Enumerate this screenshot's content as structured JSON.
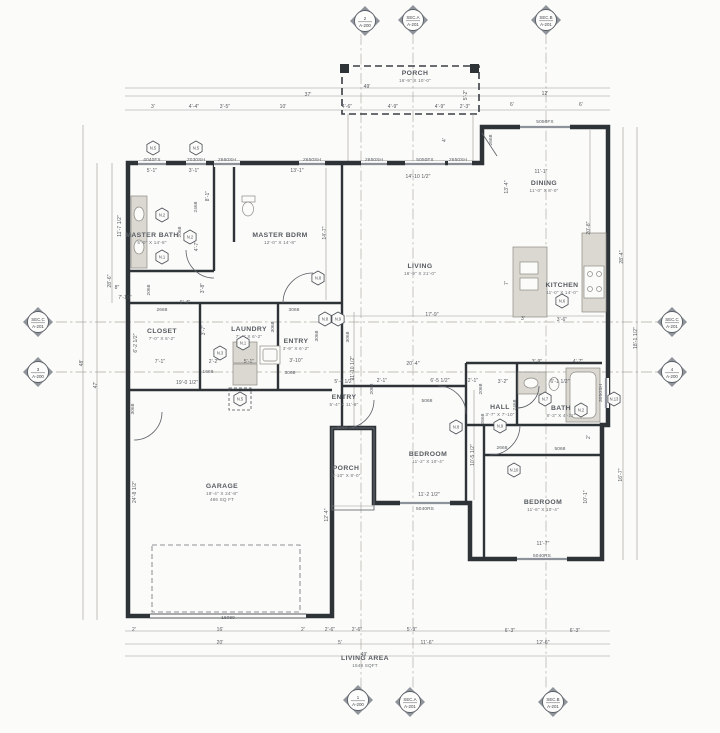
{
  "drawing": {
    "type": "architectural-floor-plan",
    "footer_label": "LIVING AREA",
    "footer_value": "1549 SQFT"
  },
  "rooms": [
    {
      "name": "PORCH",
      "size": "16'-9\" X 10'-0\"",
      "x": 415,
      "y": 75
    },
    {
      "name": "MASTER BATH",
      "size": "5'-0\" X 14'-8\"",
      "x": 152,
      "y": 237
    },
    {
      "name": "MASTER BDRM",
      "size": "12'-0\" X 14'-8\"",
      "x": 280,
      "y": 237
    },
    {
      "name": "LIVING",
      "size": "16'-9\" X 21'-0\"",
      "x": 420,
      "y": 268
    },
    {
      "name": "DINING",
      "size": "11'-0\" X 8'-0\"",
      "x": 544,
      "y": 185
    },
    {
      "name": "KITCHEN",
      "size": "11'-0\" X 14'-0\"",
      "x": 562,
      "y": 287
    },
    {
      "name": "CLOSET",
      "size": "7'-0\" X 6'-2\"",
      "x": 162,
      "y": 333
    },
    {
      "name": "LAUNDRY",
      "size": "7'-4\" X 6'-2\"",
      "x": 249,
      "y": 331
    },
    {
      "name": "ENTRY",
      "size": "3'-9\" X 6'-2\"",
      "x": 296,
      "y": 343
    },
    {
      "name": "ENTRY",
      "size": "5'-4\" X 11'-8\"",
      "x": 344,
      "y": 399
    },
    {
      "name": "PORCH",
      "size": "4'-10\" X 8'-0\"",
      "x": 346,
      "y": 470
    },
    {
      "name": "HALL",
      "size": "3'-7\" X 7'-10\"",
      "x": 500,
      "y": 409
    },
    {
      "name": "BATH",
      "size": "8'-3\" X 4'-11\"",
      "x": 561,
      "y": 410
    },
    {
      "name": "BEDROOM",
      "size": "11'-2\" X 10'-4\"",
      "x": 428,
      "y": 456
    },
    {
      "name": "BEDROOM",
      "size": "11'-6\" X 10'-4\"",
      "x": 543,
      "y": 504
    },
    {
      "name": "GARAGE",
      "size": "19'-4\" X 24'-8\"",
      "size2": "486 SQ FT",
      "x": 222,
      "y": 488
    },
    {
      "name": "LIVING AREA",
      "size": "1549 SQFT",
      "x": 365,
      "y": 660
    }
  ],
  "section_markers": [
    {
      "num": "2",
      "sheet": "A-200",
      "x": 365,
      "y": 21
    },
    {
      "num": "SEC.A",
      "sheet": "A-201",
      "x": 413,
      "y": 20
    },
    {
      "num": "SEC.B",
      "sheet": "A-201",
      "x": 546,
      "y": 20
    },
    {
      "num": "SEC.C",
      "sheet": "A-201",
      "x": 38,
      "y": 322
    },
    {
      "num": "3",
      "sheet": "A-200",
      "x": 38,
      "y": 372
    },
    {
      "num": "SEC.C",
      "sheet": "A-201",
      "x": 672,
      "y": 322
    },
    {
      "num": "4",
      "sheet": "A-200",
      "x": 672,
      "y": 372
    },
    {
      "num": "1",
      "sheet": "A-200",
      "x": 358,
      "y": 700
    },
    {
      "num": "SEC.A",
      "sheet": "A-201",
      "x": 410,
      "y": 702
    },
    {
      "num": "SEC.B",
      "sheet": "A-201",
      "x": 553,
      "y": 702
    }
  ],
  "keynotes": [
    {
      "label": "N.5",
      "x": 153,
      "y": 148
    },
    {
      "label": "N.5",
      "x": 196,
      "y": 148
    },
    {
      "label": "N.2",
      "x": 162,
      "y": 215
    },
    {
      "label": "N.2",
      "x": 190,
      "y": 237
    },
    {
      "label": "N.1",
      "x": 162,
      "y": 257
    },
    {
      "label": "N.8",
      "x": 318,
      "y": 278
    },
    {
      "label": "N.8",
      "x": 325,
      "y": 319
    },
    {
      "label": "N.9",
      "x": 338,
      "y": 319
    },
    {
      "label": "N.1",
      "x": 243,
      "y": 343
    },
    {
      "label": "N.3",
      "x": 220,
      "y": 353
    },
    {
      "label": "N.5",
      "x": 240,
      "y": 399,
      "dashed": true
    },
    {
      "label": "N.6",
      "x": 562,
      "y": 301
    },
    {
      "label": "N.7",
      "x": 545,
      "y": 399
    },
    {
      "label": "N.2",
      "x": 581,
      "y": 410
    },
    {
      "label": "N.13",
      "x": 614,
      "y": 399
    },
    {
      "label": "N.9",
      "x": 500,
      "y": 426
    },
    {
      "label": "N.8",
      "x": 456,
      "y": 427
    },
    {
      "label": "N.10",
      "x": 514,
      "y": 470
    }
  ],
  "windows": [
    {
      "label": "4040FX",
      "x": 152,
      "y": 161,
      "bar": [
        138,
        164,
        166,
        164
      ]
    },
    {
      "label": "2030SH",
      "x": 196,
      "y": 161,
      "bar": [
        186,
        164,
        206,
        164
      ]
    },
    {
      "label": "2660SH",
      "x": 227,
      "y": 161,
      "bar": [
        214,
        164,
        240,
        164
      ]
    },
    {
      "label": "2650SH",
      "x": 312,
      "y": 161,
      "bar": [
        299,
        164,
        325,
        164
      ]
    },
    {
      "label": "2650SH",
      "x": 374,
      "y": 161,
      "bar": [
        361,
        164,
        387,
        164
      ]
    },
    {
      "label": "5050FX",
      "x": 425,
      "y": 161,
      "bar": [
        405,
        164,
        445,
        164
      ]
    },
    {
      "label": "2650SH",
      "x": 458,
      "y": 161,
      "bar": [
        448,
        164,
        472,
        164
      ]
    },
    {
      "label": "5050FX",
      "x": 545,
      "y": 123,
      "bar": [
        520,
        127,
        570,
        127
      ]
    },
    {
      "label": "3050SH",
      "x": 602,
      "y": 393,
      "rot": true,
      "bar": [
        606,
        378,
        606,
        408
      ]
    },
    {
      "label": "5040RS",
      "x": 425,
      "y": 510,
      "bar": [
        400,
        503,
        450,
        503
      ]
    },
    {
      "label": "5040RS",
      "x": 542,
      "y": 557,
      "bar": [
        517,
        559,
        567,
        559
      ]
    },
    {
      "label": "16080",
      "x": 228,
      "y": 619
    }
  ],
  "doors": [
    {
      "label": "2468",
      "x": 197,
      "y": 207,
      "rot": true
    },
    {
      "label": "2068",
      "x": 181,
      "y": 232,
      "rot": true
    },
    {
      "label": "2068",
      "x": 150,
      "y": 290,
      "rot": true
    },
    {
      "label": "2668",
      "x": 162,
      "y": 311
    },
    {
      "label": "3068",
      "x": 294,
      "y": 311
    },
    {
      "label": "3068",
      "x": 274,
      "y": 327,
      "rot": true
    },
    {
      "label": "1668",
      "x": 208,
      "y": 373
    },
    {
      "label": "3068",
      "x": 134,
      "y": 409,
      "rot": true
    },
    {
      "label": "3068",
      "x": 290,
      "y": 374
    },
    {
      "label": "3068",
      "x": 318,
      "y": 336,
      "rot": true
    },
    {
      "label": "3068",
      "x": 349,
      "y": 337,
      "rot": true
    },
    {
      "label": "3068",
      "x": 342,
      "y": 429
    },
    {
      "label": "2068",
      "x": 373,
      "y": 389,
      "rot": true
    },
    {
      "label": "2068",
      "x": 482,
      "y": 389,
      "rot": true
    },
    {
      "label": "5068",
      "x": 427,
      "y": 402
    },
    {
      "label": "2468",
      "x": 516,
      "y": 405,
      "rot": true
    },
    {
      "label": "2668",
      "x": 484,
      "y": 419,
      "rot": true
    },
    {
      "label": "2668",
      "x": 502,
      "y": 449
    },
    {
      "label": "5068",
      "x": 560,
      "y": 450
    },
    {
      "label": "2668",
      "x": 492,
      "y": 140,
      "rot": true
    }
  ],
  "dims": [
    {
      "label": "49'",
      "x": 367,
      "y": 88
    },
    {
      "label": "37'",
      "x": 308,
      "y": 96
    },
    {
      "label": "12'",
      "x": 545,
      "y": 95
    },
    {
      "label": "3'",
      "x": 153,
      "y": 108
    },
    {
      "label": "4'-4\"",
      "x": 194,
      "y": 108
    },
    {
      "label": "3'-5\"",
      "x": 225,
      "y": 108
    },
    {
      "label": "10'",
      "x": 283,
      "y": 108
    },
    {
      "label": "4'-6\"",
      "x": 347,
      "y": 108
    },
    {
      "label": "4'-9\"",
      "x": 393,
      "y": 108
    },
    {
      "label": "4'-9\"",
      "x": 440,
      "y": 108
    },
    {
      "label": "2'-3\"",
      "x": 465,
      "y": 108
    },
    {
      "label": "6'",
      "x": 512,
      "y": 106
    },
    {
      "label": "6'",
      "x": 581,
      "y": 106
    },
    {
      "label": "5'-2\"",
      "x": 467,
      "y": 95,
      "rot": true
    },
    {
      "label": "5'-1\"",
      "x": 152,
      "y": 172
    },
    {
      "label": "3'-1\"",
      "x": 194,
      "y": 172
    },
    {
      "label": "13'-1\"",
      "x": 297,
      "y": 172
    },
    {
      "label": "14'-10 1/2\"",
      "x": 418,
      "y": 178
    },
    {
      "label": "11'-1\"",
      "x": 541,
      "y": 173
    },
    {
      "label": "13'-4\"",
      "x": 508,
      "y": 187,
      "rot": true
    },
    {
      "label": "4'",
      "x": 446,
      "y": 140,
      "rot": true
    },
    {
      "label": "28'-6\"",
      "x": 111,
      "y": 281,
      "rot": true
    },
    {
      "label": "47'",
      "x": 97,
      "y": 385,
      "rot": true
    },
    {
      "label": "48'",
      "x": 83,
      "y": 363,
      "rot": true
    },
    {
      "label": "11'-7 1/2\"",
      "x": 121,
      "y": 226,
      "rot": true
    },
    {
      "label": "8\"",
      "x": 117,
      "y": 289
    },
    {
      "label": "7'-10\"",
      "x": 125,
      "y": 299
    },
    {
      "label": "8'-1\"",
      "x": 209,
      "y": 196,
      "rot": true
    },
    {
      "label": "4'-7\"",
      "x": 198,
      "y": 246,
      "rot": true
    },
    {
      "label": "3'-8\"",
      "x": 204,
      "y": 288,
      "rot": true
    },
    {
      "label": "6'-4\"",
      "x": 185,
      "y": 304
    },
    {
      "label": "14'-7\"",
      "x": 326,
      "y": 233,
      "rot": true
    },
    {
      "label": "6'-2 1/2\"",
      "x": 137,
      "y": 343,
      "rot": true
    },
    {
      "label": "3'-7\"",
      "x": 205,
      "y": 330,
      "rot": true
    },
    {
      "label": "7'-1\"",
      "x": 160,
      "y": 363
    },
    {
      "label": "2'-2\"",
      "x": 214,
      "y": 363
    },
    {
      "label": "5'-1\"",
      "x": 249,
      "y": 363
    },
    {
      "label": "3'-10\"",
      "x": 296,
      "y": 362
    },
    {
      "label": "19'-0 1/2\"",
      "x": 187,
      "y": 384
    },
    {
      "label": "11'-10 1/2\"",
      "x": 354,
      "y": 368,
      "rot": true
    },
    {
      "label": "5'-4 1/2\"",
      "x": 344,
      "y": 383
    },
    {
      "label": "20'-4\"",
      "x": 413,
      "y": 365
    },
    {
      "label": "2'-1\"",
      "x": 382,
      "y": 382
    },
    {
      "label": "6'-5 1/2\"",
      "x": 440,
      "y": 382
    },
    {
      "label": "2'-1\"",
      "x": 473,
      "y": 382
    },
    {
      "label": "3'-2\"",
      "x": 503,
      "y": 383
    },
    {
      "label": "17'-9\"",
      "x": 432,
      "y": 316
    },
    {
      "label": "3'-9\"",
      "x": 537,
      "y": 363
    },
    {
      "label": "4'-7\"",
      "x": 578,
      "y": 363
    },
    {
      "label": "6'-1 1/2\"",
      "x": 560,
      "y": 383
    },
    {
      "label": "2'",
      "x": 590,
      "y": 437,
      "rot": true
    },
    {
      "label": "10'-5 1/2\"",
      "x": 474,
      "y": 455,
      "rot": true
    },
    {
      "label": "11'-2 1/2\"",
      "x": 429,
      "y": 496
    },
    {
      "label": "11'-7\"",
      "x": 543,
      "y": 545
    },
    {
      "label": "10'-1\"",
      "x": 587,
      "y": 497,
      "rot": true
    },
    {
      "label": "16'-7\"",
      "x": 622,
      "y": 475,
      "rot": true
    },
    {
      "label": "18'-1 1/2\"",
      "x": 637,
      "y": 338,
      "rot": true
    },
    {
      "label": "20'-8\"",
      "x": 590,
      "y": 228,
      "rot": true
    },
    {
      "label": "28'-4\"",
      "x": 623,
      "y": 257,
      "rot": true
    },
    {
      "label": "7'",
      "x": 508,
      "y": 283,
      "rot": true
    },
    {
      "label": "3'",
      "x": 523,
      "y": 320
    },
    {
      "label": "3'-6\"",
      "x": 562,
      "y": 321
    },
    {
      "label": "24'-8 1/2\"",
      "x": 136,
      "y": 492,
      "rot": true
    },
    {
      "label": "12'-4\"",
      "x": 328,
      "y": 515,
      "rot": true
    },
    {
      "label": "2'",
      "x": 134,
      "y": 631
    },
    {
      "label": "16'",
      "x": 220,
      "y": 631
    },
    {
      "label": "2'",
      "x": 303,
      "y": 631
    },
    {
      "label": "2'-6\"",
      "x": 330,
      "y": 631
    },
    {
      "label": "2'-6\"",
      "x": 357,
      "y": 631
    },
    {
      "label": "5'-9\"",
      "x": 412,
      "y": 631
    },
    {
      "label": "6'-3\"",
      "x": 510,
      "y": 632
    },
    {
      "label": "6'-3\"",
      "x": 575,
      "y": 632
    },
    {
      "label": "20'",
      "x": 220,
      "y": 644
    },
    {
      "label": "5'",
      "x": 340,
      "y": 644
    },
    {
      "label": "11'-6\"",
      "x": 427,
      "y": 644
    },
    {
      "label": "12'-6\"",
      "x": 543,
      "y": 644
    },
    {
      "label": "49'",
      "x": 364,
      "y": 656
    }
  ]
}
